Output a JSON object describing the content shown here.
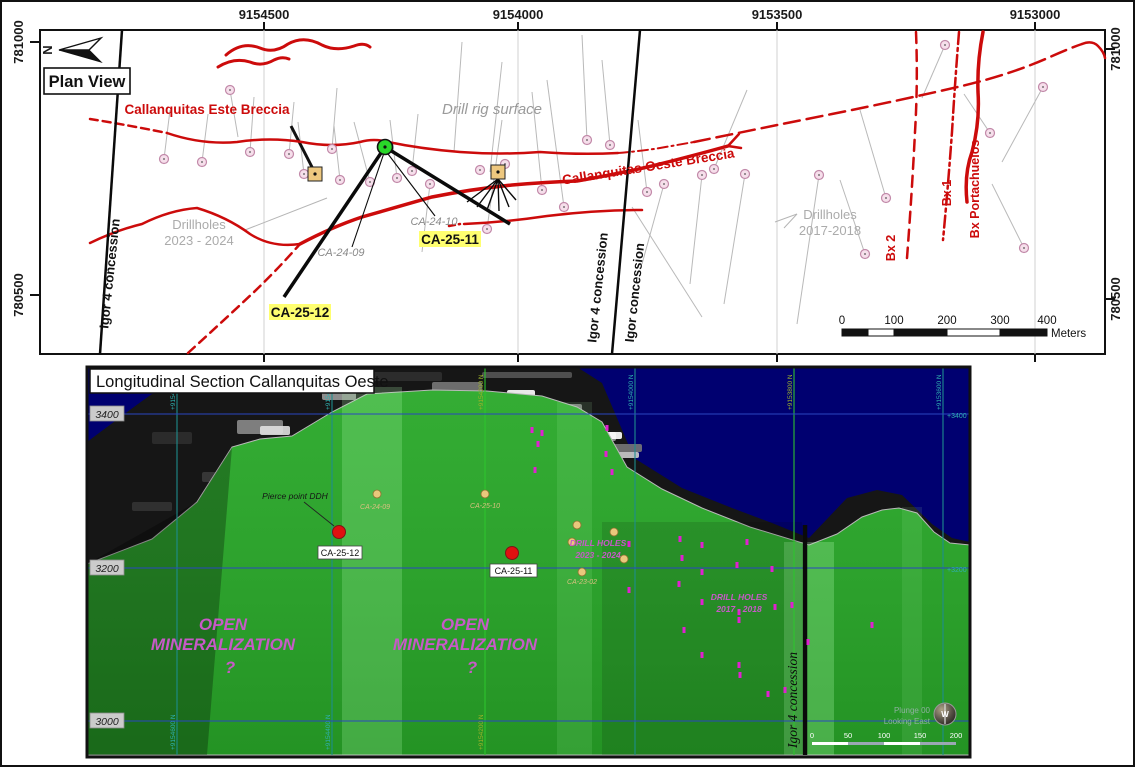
{
  "colors": {
    "red": "#cc0b0b",
    "collar_fill": "#f6dfeb",
    "collar_stroke": "#c289a9",
    "trace": "#b9b9b9",
    "tan_pad": "#eec87f",
    "green_dot": "#29d629",
    "hl_yellow": "#ffff70",
    "navy": "#000070",
    "terrain_green": "#2da22d",
    "rock": "#161616",
    "magenta_text": "#c75ac7",
    "magenta_marker": "#e020d0",
    "teal": "#2fb0b0",
    "yellow_green": "#9cb32a",
    "blue_line": "#2a46c0",
    "grid_green": "#2ec52e",
    "grid_teal": "#1e8e8e",
    "tan_dot": "#e9c87c",
    "red_dot": "#e01010"
  },
  "plan": {
    "title_box": "Plan View",
    "north_letter": "N",
    "axis_top": [
      {
        "label": "9154500",
        "x": 262
      },
      {
        "label": "9154000",
        "x": 516
      },
      {
        "label": "9153500",
        "x": 775
      },
      {
        "label": "9153000",
        "x": 1033
      }
    ],
    "axis_left": [
      {
        "label": "781000",
        "y": 40
      },
      {
        "label": "780500",
        "y": 293
      }
    ],
    "axis_right": [
      {
        "label": "781000",
        "y": 47
      },
      {
        "label": "780500",
        "y": 297
      }
    ],
    "grid_x": [
      262,
      516,
      775,
      1033
    ],
    "labels": {
      "este": "Callanquitas Este Breccia",
      "oeste": "Callanquitas Oeste Breccia",
      "drill_rig": "Drill rig surface",
      "dh2023": [
        "Drillholes",
        "2023 - 2024"
      ],
      "dh2017": [
        "Drillholes",
        "2017-2018"
      ],
      "ca2409": "CA-24-09",
      "ca2410": "CA-24-10",
      "ca2511": "CA-25-11",
      "ca2512": "CA-25-12",
      "igor4_left": "Igor 4 concession",
      "igor4_mid": "Igor 4 concession",
      "igor_mid": "Igor concession",
      "bx1": "Bx 1",
      "bx2": "Bx 2",
      "bxport": "Bx Portachuelos"
    },
    "scalebar": {
      "ticks": [
        "0",
        "100",
        "200",
        "300",
        "400"
      ],
      "unit": "Meters"
    },
    "concession_lines": [
      [
        120,
        28,
        98,
        352
      ],
      [
        638,
        28,
        610,
        352
      ]
    ],
    "red_paths": [
      {
        "d": "M224,53 Q240,39 258,46 Q272,52 286,42 Q302,33 320,43 Q334,50 352,44 Q362,40 368,45",
        "w": 3
      },
      {
        "d": "M216,65 Q232,55 248,60 Q260,65 272,58 Q280,54 287,57",
        "w": 3
      },
      {
        "d": "M88,117 Q120,122 165,131",
        "w": 2.5,
        "dash": "8,5"
      },
      {
        "d": "M165,131 Q200,143 235,140 Q268,135 300,140 Q330,146 358,140 Q372,136 386,140 Q420,147 458,150 Q498,153 538,150 Q578,153 616,151",
        "w": 2.5
      },
      {
        "d": "M616,151 Q640,149 658,146 Q675,143 692,140",
        "w": 2,
        "dash": "10,4,2,4"
      },
      {
        "d": "M692,140 Q760,126 830,112 Q900,98 960,84 Q1010,72 1048,55 Q1068,46 1080,42",
        "w": 2.5,
        "dash": "16,7"
      },
      {
        "d": "M1080,42 Q1090,38 1096,44 Q1102,50 1103,56",
        "w": 2.5
      },
      {
        "d": "M186,351 Q220,320 252,290 Q275,268 298,242",
        "w": 2.5,
        "dash": "9,6"
      },
      {
        "d": "M298,242 Q330,225 360,215 Q395,205 430,195 Q470,187 510,183 Q545,180 575,179 Q615,172 650,164 Q690,154 726,144",
        "w": 3.5
      },
      {
        "d": "M726,144 L737,132 M726,144 L739,146",
        "w": 2.5
      },
      {
        "d": "M88,241 Q115,228 140,222 Q168,208 195,206 Q225,215 248,232 Q270,246 298,242",
        "w": 2.5
      },
      {
        "d": "M447,224 L458,222",
        "w": 2.5,
        "dash": "6,4"
      },
      {
        "d": "M462,222 Q505,220 545,214 Q595,208 640,208",
        "w": 2.5
      },
      {
        "d": "M914,30 Q916,80 913,130 Q910,190 905,256",
        "w": 2.5,
        "dash": "11,7"
      },
      {
        "d": "M957,30 Q953,80 950,130 Q946,185 941,238",
        "w": 2.5,
        "dash": "12,4,3,4"
      },
      {
        "d": "M981,30 Q975,60 976,90 Q978,120 970,150 Q962,172 965,200",
        "w": 3.5
      }
    ],
    "collars": [
      [
        228,
        88
      ],
      [
        162,
        157
      ],
      [
        200,
        160
      ],
      [
        248,
        150
      ],
      [
        287,
        152
      ],
      [
        330,
        147
      ],
      [
        302,
        172
      ],
      [
        338,
        178
      ],
      [
        368,
        180
      ],
      [
        395,
        176
      ],
      [
        410,
        169
      ],
      [
        428,
        182
      ],
      [
        478,
        168
      ],
      [
        503,
        162
      ],
      [
        485,
        227
      ],
      [
        540,
        188
      ],
      [
        562,
        205
      ],
      [
        585,
        138
      ],
      [
        608,
        143
      ],
      [
        645,
        190
      ],
      [
        662,
        182
      ],
      [
        700,
        173
      ],
      [
        712,
        167
      ],
      [
        743,
        172
      ],
      [
        817,
        173
      ],
      [
        884,
        196
      ],
      [
        863,
        252
      ],
      [
        943,
        43
      ],
      [
        1041,
        85
      ],
      [
        988,
        131
      ],
      [
        1022,
        246
      ]
    ],
    "traces": [
      [
        228,
        88,
        236,
        135
      ],
      [
        162,
        157,
        168,
        108
      ],
      [
        200,
        160,
        206,
        112
      ],
      [
        248,
        150,
        252,
        95
      ],
      [
        287,
        152,
        292,
        100
      ],
      [
        330,
        147,
        335,
        86
      ],
      [
        302,
        172,
        296,
        120
      ],
      [
        338,
        178,
        332,
        124
      ],
      [
        368,
        180,
        352,
        120
      ],
      [
        395,
        176,
        388,
        118
      ],
      [
        410,
        169,
        416,
        112
      ],
      [
        428,
        182,
        420,
        250
      ],
      [
        485,
        227,
        500,
        118
      ],
      [
        540,
        188,
        530,
        90
      ],
      [
        562,
        205,
        545,
        78
      ],
      [
        585,
        138,
        580,
        33
      ],
      [
        608,
        143,
        600,
        58
      ],
      [
        645,
        190,
        636,
        118
      ],
      [
        662,
        182,
        640,
        262
      ],
      [
        700,
        173,
        688,
        282
      ],
      [
        712,
        167,
        745,
        88
      ],
      [
        743,
        172,
        722,
        302
      ],
      [
        817,
        173,
        795,
        322
      ],
      [
        884,
        196,
        858,
        108
      ],
      [
        863,
        252,
        838,
        178
      ],
      [
        943,
        43,
        920,
        96
      ],
      [
        1041,
        85,
        1000,
        160
      ],
      [
        988,
        131,
        962,
        92
      ],
      [
        1022,
        246,
        990,
        182
      ],
      [
        500,
        60,
        488,
        170
      ],
      [
        630,
        205,
        700,
        315
      ],
      [
        460,
        40,
        452,
        150
      ]
    ],
    "leaders": {
      "dh2023": [
        243,
        228,
        325,
        196
      ],
      "dh2017a": [
        782,
        226,
        795,
        212
      ],
      "dh2017b": [
        773,
        220,
        795,
        212
      ],
      "este_tick": [
        289,
        124,
        311,
        167
      ]
    },
    "planned": {
      "rig": [
        383,
        145
      ],
      "ca2512_line": [
        383,
        145,
        282,
        295
      ],
      "ca2511_line": [
        383,
        145,
        508,
        222
      ],
      "ca2409_line": [
        383,
        148,
        350,
        245
      ],
      "ca2410_line": [
        383,
        148,
        433,
        214
      ],
      "pads": [
        [
          313,
          172
        ],
        [
          496,
          170
        ]
      ],
      "fan": [
        [
          496,
          177,
          465,
          200
        ],
        [
          496,
          177,
          475,
          205
        ],
        [
          496,
          177,
          485,
          208
        ],
        [
          496,
          177,
          497,
          209
        ],
        [
          496,
          177,
          507,
          205
        ],
        [
          496,
          177,
          514,
          198
        ]
      ]
    },
    "scalebar_geo": {
      "x0": 840,
      "y": 327,
      "seg": [
        26,
        26,
        53,
        53,
        47
      ]
    }
  },
  "section": {
    "title": "Longitudinal Section Callanquitas Oeste",
    "elev_left": [
      {
        "t": "3400",
        "y": 412
      },
      {
        "t": "3200",
        "y": 566
      },
      {
        "t": "3000",
        "y": 719
      }
    ],
    "elev_right": [
      {
        "t": "+3400",
        "y": 416
      },
      {
        "t": "+3200",
        "y": 570
      }
    ],
    "grid": [
      {
        "t": "+9154600 N",
        "x": 175,
        "c": "teal",
        "bottom": true
      },
      {
        "t": "+9154400 N",
        "x": 330,
        "c": "teal",
        "bottom": true
      },
      {
        "t": "+9154200 N",
        "x": 483,
        "c": "ygreen",
        "bottom": true
      },
      {
        "t": "+9154000 N",
        "x": 633,
        "c": "teal",
        "bottom": false
      },
      {
        "t": "+9153800 N",
        "x": 792,
        "c": "ygreen",
        "bottom": false
      },
      {
        "t": "+9153600 N",
        "x": 941,
        "c": "teal",
        "bottom": false
      }
    ],
    "terrain": {
      "rock": "130,365 330,365 545,365 575,365 600,381 615,416 632,456 680,486 730,506 770,521 807,536 845,496 875,488 900,493 930,522 950,536 968,540 968,585 85,585 85,438 150,392 240,372",
      "green": "85,562 150,537 195,500 230,445 258,437 290,434 330,410 365,392 430,388 485,389 540,394 575,405 600,420 625,465 660,487 700,506 748,525 807,543 835,532 860,515 880,508 897,506 915,511 932,530 948,541 968,543 968,753 85,753",
      "navy_wedge": "85,386 152,390 85,440"
    },
    "rock_patches": [
      [
        150,
        430,
        40,
        12,
        "#2e2e2e"
      ],
      [
        200,
        470,
        55,
        10,
        "#3a3a3a"
      ],
      [
        235,
        418,
        46,
        14,
        "#8a8a8a"
      ],
      [
        258,
        424,
        30,
        9,
        "#e0e0e0"
      ],
      [
        300,
        372,
        60,
        10,
        "#4a4a4a"
      ],
      [
        320,
        390,
        34,
        8,
        "#9a9a9a"
      ],
      [
        360,
        370,
        80,
        9,
        "#2f2f2f"
      ],
      [
        430,
        380,
        50,
        12,
        "#777777"
      ],
      [
        470,
        392,
        46,
        11,
        "#dddddd"
      ],
      [
        505,
        388,
        28,
        8,
        "#ffffff"
      ],
      [
        520,
        402,
        60,
        9,
        "#888888"
      ],
      [
        540,
        418,
        40,
        8,
        "#eeeeee"
      ],
      [
        560,
        430,
        54,
        9,
        "#999999"
      ],
      [
        590,
        430,
        30,
        7,
        "#ffffff"
      ],
      [
        600,
        442,
        40,
        8,
        "#777777"
      ],
      [
        130,
        500,
        40,
        9,
        "#333333"
      ],
      [
        160,
        530,
        36,
        8,
        "#3d3d3d"
      ],
      [
        480,
        370,
        90,
        6,
        "#555555"
      ],
      [
        250,
        440,
        26,
        6,
        "#ffffff"
      ],
      [
        615,
        450,
        22,
        6,
        "#cccccc"
      ]
    ],
    "workings": [
      [
        470,
        400,
        520,
        398
      ],
      [
        500,
        410,
        560,
        408
      ],
      [
        520,
        425,
        585,
        423
      ],
      [
        545,
        437,
        600,
        434
      ],
      [
        300,
        380,
        360,
        378
      ],
      [
        528,
        398,
        528,
        425
      ]
    ],
    "light_bands": [
      [
        340,
        385,
        60,
        0.22
      ],
      [
        555,
        400,
        35,
        0.12
      ],
      [
        782,
        540,
        50,
        0.26
      ],
      [
        900,
        505,
        20,
        0.1
      ]
    ],
    "labels": {
      "pierce": "Pierce point DDH",
      "dh2023": [
        "DRILL HOLES",
        "2023 - 2024"
      ],
      "dh2017": [
        "DRILL HOLES",
        "2017 - 2018"
      ],
      "open_left": [
        "OPEN",
        "MINERALIZATION",
        "?"
      ],
      "open_right": [
        "OPEN",
        "MINERALIZATION",
        "?"
      ],
      "igor": "Igor 4 concession",
      "plunge": [
        "Plunge 00",
        "Looking East"
      ],
      "compass_letter": "W"
    },
    "hole_labels": [
      {
        "t": "CA-24-09",
        "x": 373,
        "y": 507
      },
      {
        "t": "CA-25-10",
        "x": 483,
        "y": 506
      },
      {
        "t": "CA-23-02",
        "x": 580,
        "y": 582
      }
    ],
    "red_holes": [
      {
        "label": "CA-25-12",
        "x": 337,
        "y": 530,
        "bx": 316,
        "by": 544,
        "bw": 44
      },
      {
        "label": "CA-25-11",
        "x": 510,
        "y": 551,
        "bx": 488,
        "by": 562,
        "bw": 47
      }
    ],
    "tan_dots": [
      [
        375,
        492
      ],
      [
        483,
        492
      ],
      [
        575,
        523
      ],
      [
        612,
        530
      ],
      [
        570,
        540
      ],
      [
        622,
        557
      ],
      [
        580,
        570
      ]
    ],
    "magenta_markers": [
      [
        530,
        428
      ],
      [
        536,
        442
      ],
      [
        540,
        431
      ],
      [
        605,
        426
      ],
      [
        604,
        452
      ],
      [
        533,
        468
      ],
      [
        610,
        470
      ],
      [
        627,
        542
      ],
      [
        678,
        537
      ],
      [
        700,
        543
      ],
      [
        680,
        556
      ],
      [
        735,
        563
      ],
      [
        770,
        567
      ],
      [
        700,
        570
      ],
      [
        677,
        582
      ],
      [
        627,
        588
      ],
      [
        700,
        600
      ],
      [
        773,
        605
      ],
      [
        737,
        610
      ],
      [
        737,
        618
      ],
      [
        682,
        628
      ],
      [
        700,
        653
      ],
      [
        737,
        663
      ],
      [
        738,
        673
      ],
      [
        870,
        623
      ],
      [
        766,
        692
      ],
      [
        783,
        688
      ],
      [
        790,
        603
      ],
      [
        806,
        640
      ],
      [
        745,
        540
      ]
    ],
    "concession_x": 803,
    "scalebar": [
      "0",
      "50",
      "100",
      "150",
      "200"
    ]
  }
}
